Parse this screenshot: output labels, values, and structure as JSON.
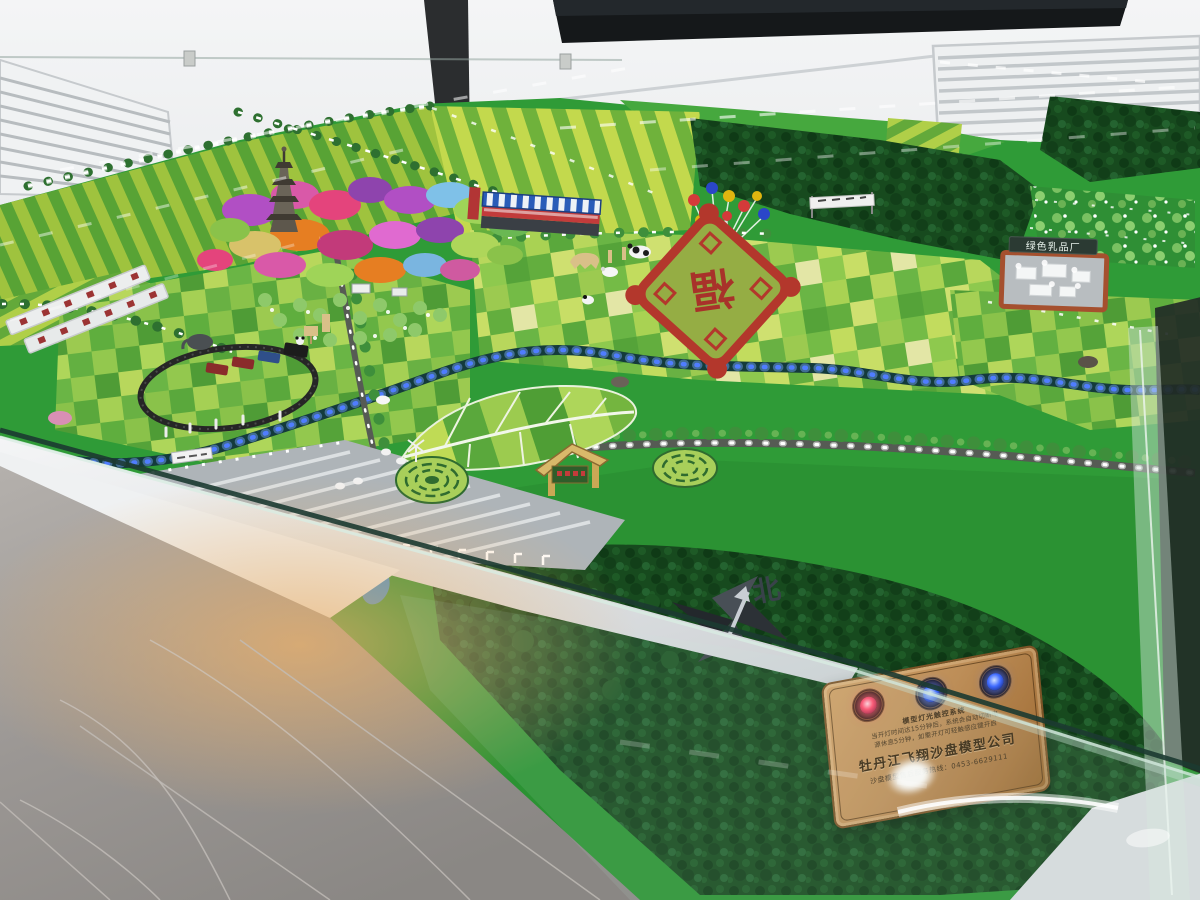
{
  "scene": {
    "type": "photograph",
    "subject": "Illuminated agricultural eco-park sand-table scale model displayed in a glass case in a showroom",
    "room": {
      "wall_color": "#eef0f1",
      "tv_screen_color": "#15181a",
      "floor_material": "gray marble tile",
      "case_underglow_color": "#e2a559"
    }
  },
  "model": {
    "labels": {
      "dairy_factory_sign": "绿色乳品厂",
      "compass_north": "北",
      "field_art_character": "福"
    },
    "features": [
      "pagoda",
      "flower-garden",
      "striped-crop-fields",
      "patchwork-fields",
      "leaf-shaped-field-art",
      "fortune-character-field-art",
      "toy-train",
      "greenhouses",
      "led-lit-river",
      "tree-lined-roads",
      "street-light-leds",
      "balloon-cluster",
      "farm-animal-figures",
      "panda-figures",
      "circular-hedge-mazes",
      "entrance-gate",
      "dairy-factory",
      "pine-forest",
      "compass-rose"
    ],
    "palette": {
      "grass": "#2f9b37",
      "field_stripe_light": "#c3d94d",
      "field_stripe_dark": "#58a335",
      "forest": "#174a1e",
      "river_led": "#4f7dff",
      "road_led": "#ffffff",
      "flower_pink": "#d959a8",
      "flower_purple": "#b14fc4",
      "fortune_red": "#b3372c"
    }
  },
  "plaque": {
    "system_title": "模型灯光触控系统",
    "instructions": [
      "当开灯时间达15分钟后，系统会自动切断电",
      "源休息5分钟，如需开灯可轻触感应键开启"
    ],
    "company_name": "牡丹江飞翔沙盘模型公司",
    "hotline_label": "沙盘模型售后服务热线：",
    "hotline_number": "0453-6629111",
    "material_color": "#bd8e58",
    "buttons": [
      "red",
      "blue",
      "blue"
    ]
  }
}
